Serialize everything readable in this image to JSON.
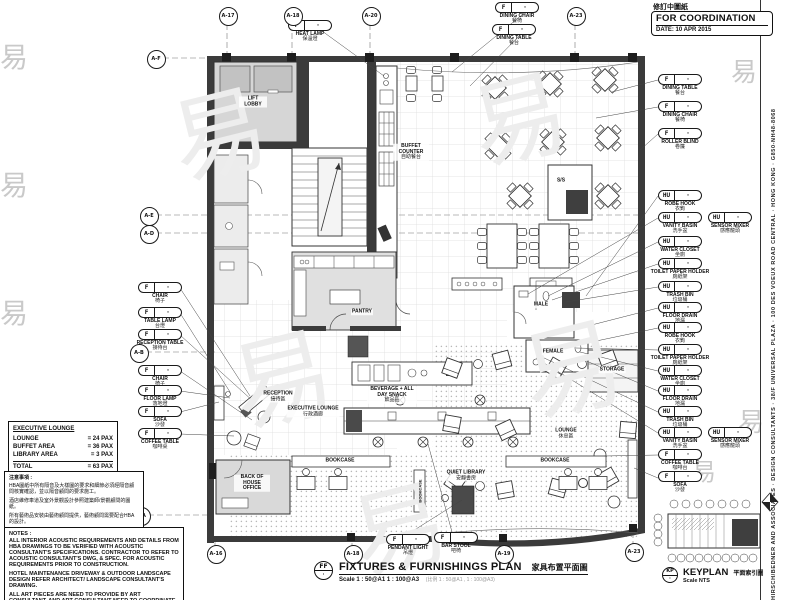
{
  "header": {
    "revision_note": "修訂中圖紙",
    "status": "FOR COORDINATION",
    "date": "DATE: 10 APR 2015"
  },
  "border_text": "HIRSCH/BEDNER AND ASSOCIATES · DESIGN CONSULTANTS · 38/F UNIVERSAL PLAZA · 100 DES VOEUX ROAD CENTRAL · HONG KONG · G850-NH48-8068",
  "watermark": {
    "glyph": "易"
  },
  "stats": {
    "title": "EXECUTIVE LOUNGE",
    "rows": [
      {
        "label": "LOUNGE",
        "value": "= 24 PAX"
      },
      {
        "label": "BUFFET AREA",
        "value": "= 36 PAX"
      },
      {
        "label": "LIBRARY AREA",
        "value": "= 3 PAX"
      }
    ],
    "total": {
      "label": "TOTAL",
      "value": "= 63 PAX"
    }
  },
  "notes_cn": {
    "title": "注意事項 :",
    "lines": [
      "HBA圖紙中所有隔音及大樣圖的要求和細節必須經隔音顧問核實確認，並以隔音顧問的要求施工。",
      "酒店維修車道及室外景觀設計參照建築師/景觀顧問的圖紙。",
      "所有藝術品安裝由藝術顧問提供，藝術顧問需要配合HBA的設計。"
    ]
  },
  "notes": {
    "title": "NOTES :",
    "paragraphs": [
      "ALL INTERIOR ACOUSTIC REQUIREMENTS AND DETAILS FROM HBA DRAWINGS TO BE VERIFIED WITH ACOUSTIC CONSULTANT'S SPECIFICATIONS. CONTRACTOR TO REFER TO ACOUSTIC CONSULTANT'S DWG, & SPEC. FOR ACOUSTIC REQUIREMENTS PRIOR TO CONSTRUCTION.",
      "HOTEL MAINTENANCE DRIVEWAY & OUTDOOR LANDSCAPE DESIGN REFER ARCHITECT/ LANDSCAPE CONSULTANT'S DRAWING.",
      "ALL ART PIECES ARE NEED TO PROVIDE BY ART CONSULTANT, AND ART CONSULTANT NEED TO COORDINATE WITH HBA."
    ]
  },
  "title_block": {
    "tag_top": "FF",
    "tag_bottom": "·",
    "title": "FIXTURES & FURNISHINGS PLAN",
    "title_cn": "家具布置平面圖",
    "scale": "Scale 1 : 50@A1  1 : 100@A3",
    "scale_note": "(比例 1 : 50@A1 , 1 : 100@A3)"
  },
  "keyplan": {
    "tag_top": "KP",
    "tag_bottom": "·",
    "title": "KEYPLAN",
    "title_cn": "平面索引圖",
    "scale": "Scale NTS"
  },
  "grid": {
    "top": [
      "A-17",
      "A-18",
      "A-20",
      "A-23"
    ],
    "bottom": [
      "A-16",
      "A-18",
      "A-19",
      "A-23"
    ],
    "left": [
      "A-F",
      "A-E",
      "A-D",
      "A-B",
      "A-A"
    ]
  },
  "rooms": {
    "lift_lobby": "LIFT LOBBY",
    "buffet_counter": "BUFFET COUNTER",
    "buffet_counter_cn": "自助餐台",
    "pantry": "PANTRY",
    "reception": "RECEPTION",
    "reception_cn": "接待區",
    "executive_lounge": "EXECUTIVE LOUNGE",
    "executive_lounge_cn": "行政酒廊",
    "beverage": "BEVERAGE + ALL DAY SNACK",
    "beverage_cn": "飲品區",
    "male": "MALE",
    "female": "FEMALE",
    "storage": "STORAGE",
    "lounge": "LOUNGE",
    "lounge_cn": "休息區",
    "boh": "BACK OF HOUSE OFFICE",
    "bookcase_a": "BOOKCASE",
    "bookcase_b": "BOOKCASE",
    "bookcase_c": "BOOKCASE",
    "quiet_library": "QUIET LIBRARY",
    "quiet_library_cn": "安靜書房",
    "ss": "S/S"
  },
  "callouts": {
    "dot": "·",
    "top": [
      {
        "tag": "F",
        "label": "HEAT LAMP",
        "cn": "保溫燈"
      },
      {
        "tag": "F",
        "label": "DINING CHAIR",
        "cn": "餐椅"
      },
      {
        "tag": "F",
        "label": "DINING TABLE",
        "cn": "餐台"
      }
    ],
    "right": [
      {
        "tag": "F",
        "label": "DINING TABLE",
        "cn": "餐台"
      },
      {
        "tag": "F",
        "label": "DINING CHAIR",
        "cn": "餐椅"
      },
      {
        "tag": "F",
        "label": "ROLLER BLIND",
        "cn": "卷簾"
      },
      {
        "tag": "HU",
        "label": "ROBE HOOK",
        "cn": "衣鉤"
      },
      {
        "tag": "HU",
        "label": "VANITY BASIN",
        "cn": "洗手盆"
      },
      {
        "tag": "HU",
        "label": "SENSOR MIXER",
        "cn": "感應龍頭"
      },
      {
        "tag": "HU",
        "label": "WATER CLOSET",
        "cn": "坐廁"
      },
      {
        "tag": "HU",
        "label": "TOILET PAPER HOLDER",
        "cn": "廁紙架"
      },
      {
        "tag": "HU",
        "label": "TRASH BIN",
        "cn": "垃圾桶"
      },
      {
        "tag": "HU",
        "label": "FLOOR DRAIN",
        "cn": "地漏"
      },
      {
        "tag": "HU",
        "label": "ROBE HOOK",
        "cn": "衣鉤"
      },
      {
        "tag": "HU",
        "label": "TOILET PAPER HOLDER",
        "cn": "廁紙架"
      },
      {
        "tag": "HU",
        "label": "WATER CLOSET",
        "cn": "坐廁"
      },
      {
        "tag": "HU",
        "label": "FLOOR DRAIN",
        "cn": "地漏"
      },
      {
        "tag": "HU",
        "label": "TRASH BIN",
        "cn": "垃圾桶"
      },
      {
        "tag": "HU",
        "label": "VANITY BASIN",
        "cn": "洗手盆"
      },
      {
        "tag": "HU",
        "label": "SENSOR MIXER",
        "cn": "感應龍頭"
      },
      {
        "tag": "F",
        "label": "COFFEE TABLE",
        "cn": "咖啡台"
      },
      {
        "tag": "F",
        "label": "SOFA",
        "cn": "沙發"
      }
    ],
    "left": [
      {
        "tag": "F",
        "label": "CHAIR",
        "cn": "椅子"
      },
      {
        "tag": "F",
        "label": "TABLE LAMP",
        "cn": "台燈"
      },
      {
        "tag": "F",
        "label": "RECEPTION TABLE",
        "cn": "接待台"
      },
      {
        "tag": "F",
        "label": "CHAIR",
        "cn": "椅子"
      },
      {
        "tag": "F",
        "label": "FLOOR LAMP",
        "cn": "落地燈"
      },
      {
        "tag": "F",
        "label": "SOFA",
        "cn": "沙發"
      },
      {
        "tag": "F",
        "label": "COFFEE TABLE",
        "cn": "咖啡桌"
      }
    ],
    "bottom": [
      {
        "tag": "F",
        "label": "PENDANT LIGHT",
        "cn": "吊燈"
      },
      {
        "tag": "F",
        "label": "BAR STOOL",
        "cn": "吧椅"
      }
    ]
  }
}
